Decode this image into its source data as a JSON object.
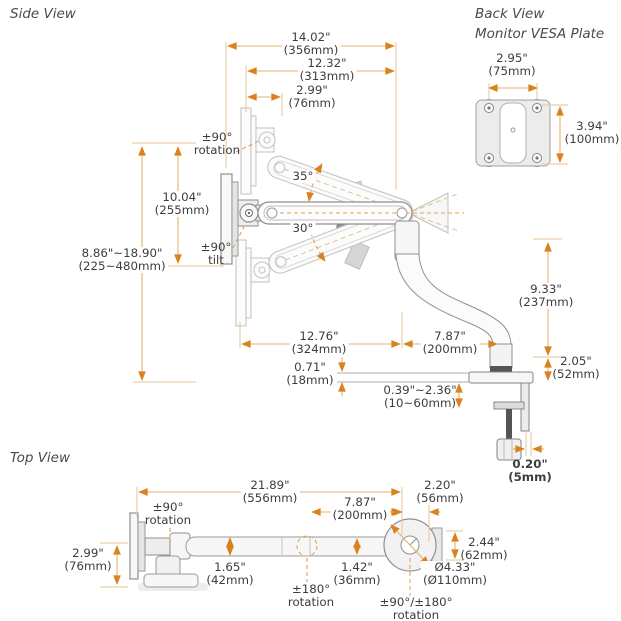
{
  "titles": {
    "side_view": "Side View",
    "back_view": "Back View",
    "back_view_subtitle": "Monitor VESA Plate",
    "top_view": "Top View"
  },
  "side_view": {
    "width_total": {
      "in": "14.02\"",
      "mm": "(356mm)"
    },
    "width_arm": {
      "in": "12.32\"",
      "mm": "(313mm)"
    },
    "width_plate": {
      "in": "2.99\"",
      "mm": "(76mm)"
    },
    "rotation_vesa": {
      "l1": "±90°",
      "l2": "rotation"
    },
    "height_adjust": {
      "in": "8.86\"~18.90\"",
      "mm": "(225~480mm)"
    },
    "height_upper": {
      "in": "10.04\"",
      "mm": "(255mm)"
    },
    "tilt": {
      "l1": "±90°",
      "l2": "tilt"
    },
    "angle_up": "35°",
    "angle_down": "30°",
    "reach_rear": {
      "in": "12.76\"",
      "mm": "(324mm)"
    },
    "reach_front": {
      "in": "7.87\"",
      "mm": "(200mm)"
    },
    "riser_height": {
      "in": "9.33\"",
      "mm": "(237mm)"
    },
    "clamp_height": {
      "in": "2.05\"",
      "mm": "(52mm)"
    },
    "plate_thickness": {
      "in": "0.71\"",
      "mm": "(18mm)"
    },
    "clamp_range": {
      "in": "0.39\"~2.36\"",
      "mm": "(10~60mm)"
    },
    "edge_clearance": {
      "in": "0.20\"",
      "mm": "(5mm)"
    }
  },
  "back_view": {
    "hole_width": {
      "in": "2.95\"",
      "mm": "(75mm)"
    },
    "hole_height": {
      "in": "3.94\"",
      "mm": "(100mm)"
    }
  },
  "top_view": {
    "length_total": {
      "in": "21.89\"",
      "mm": "(556mm)"
    },
    "base_offset": {
      "in": "2.20\"",
      "mm": "(56mm)"
    },
    "arm_section": {
      "in": "7.87\"",
      "mm": "(200mm)"
    },
    "rotation_wall": {
      "l1": "±90°",
      "l2": "rotation"
    },
    "plate_depth": {
      "in": "2.99\"",
      "mm": "(76mm)"
    },
    "arm_width": {
      "in": "1.65\"",
      "mm": "(42mm)"
    },
    "joint_width": {
      "in": "1.42\"",
      "mm": "(36mm)"
    },
    "rotation_elbow": {
      "l1": "±180°",
      "l2": "rotation"
    },
    "base_side": {
      "in": "2.44\"",
      "mm": "(62mm)"
    },
    "base_diameter": {
      "in": "Ø4.33\"",
      "mm": "(Ø110mm)"
    },
    "rotation_base": {
      "l1": "±90°/±180°",
      "l2": "rotation"
    }
  }
}
